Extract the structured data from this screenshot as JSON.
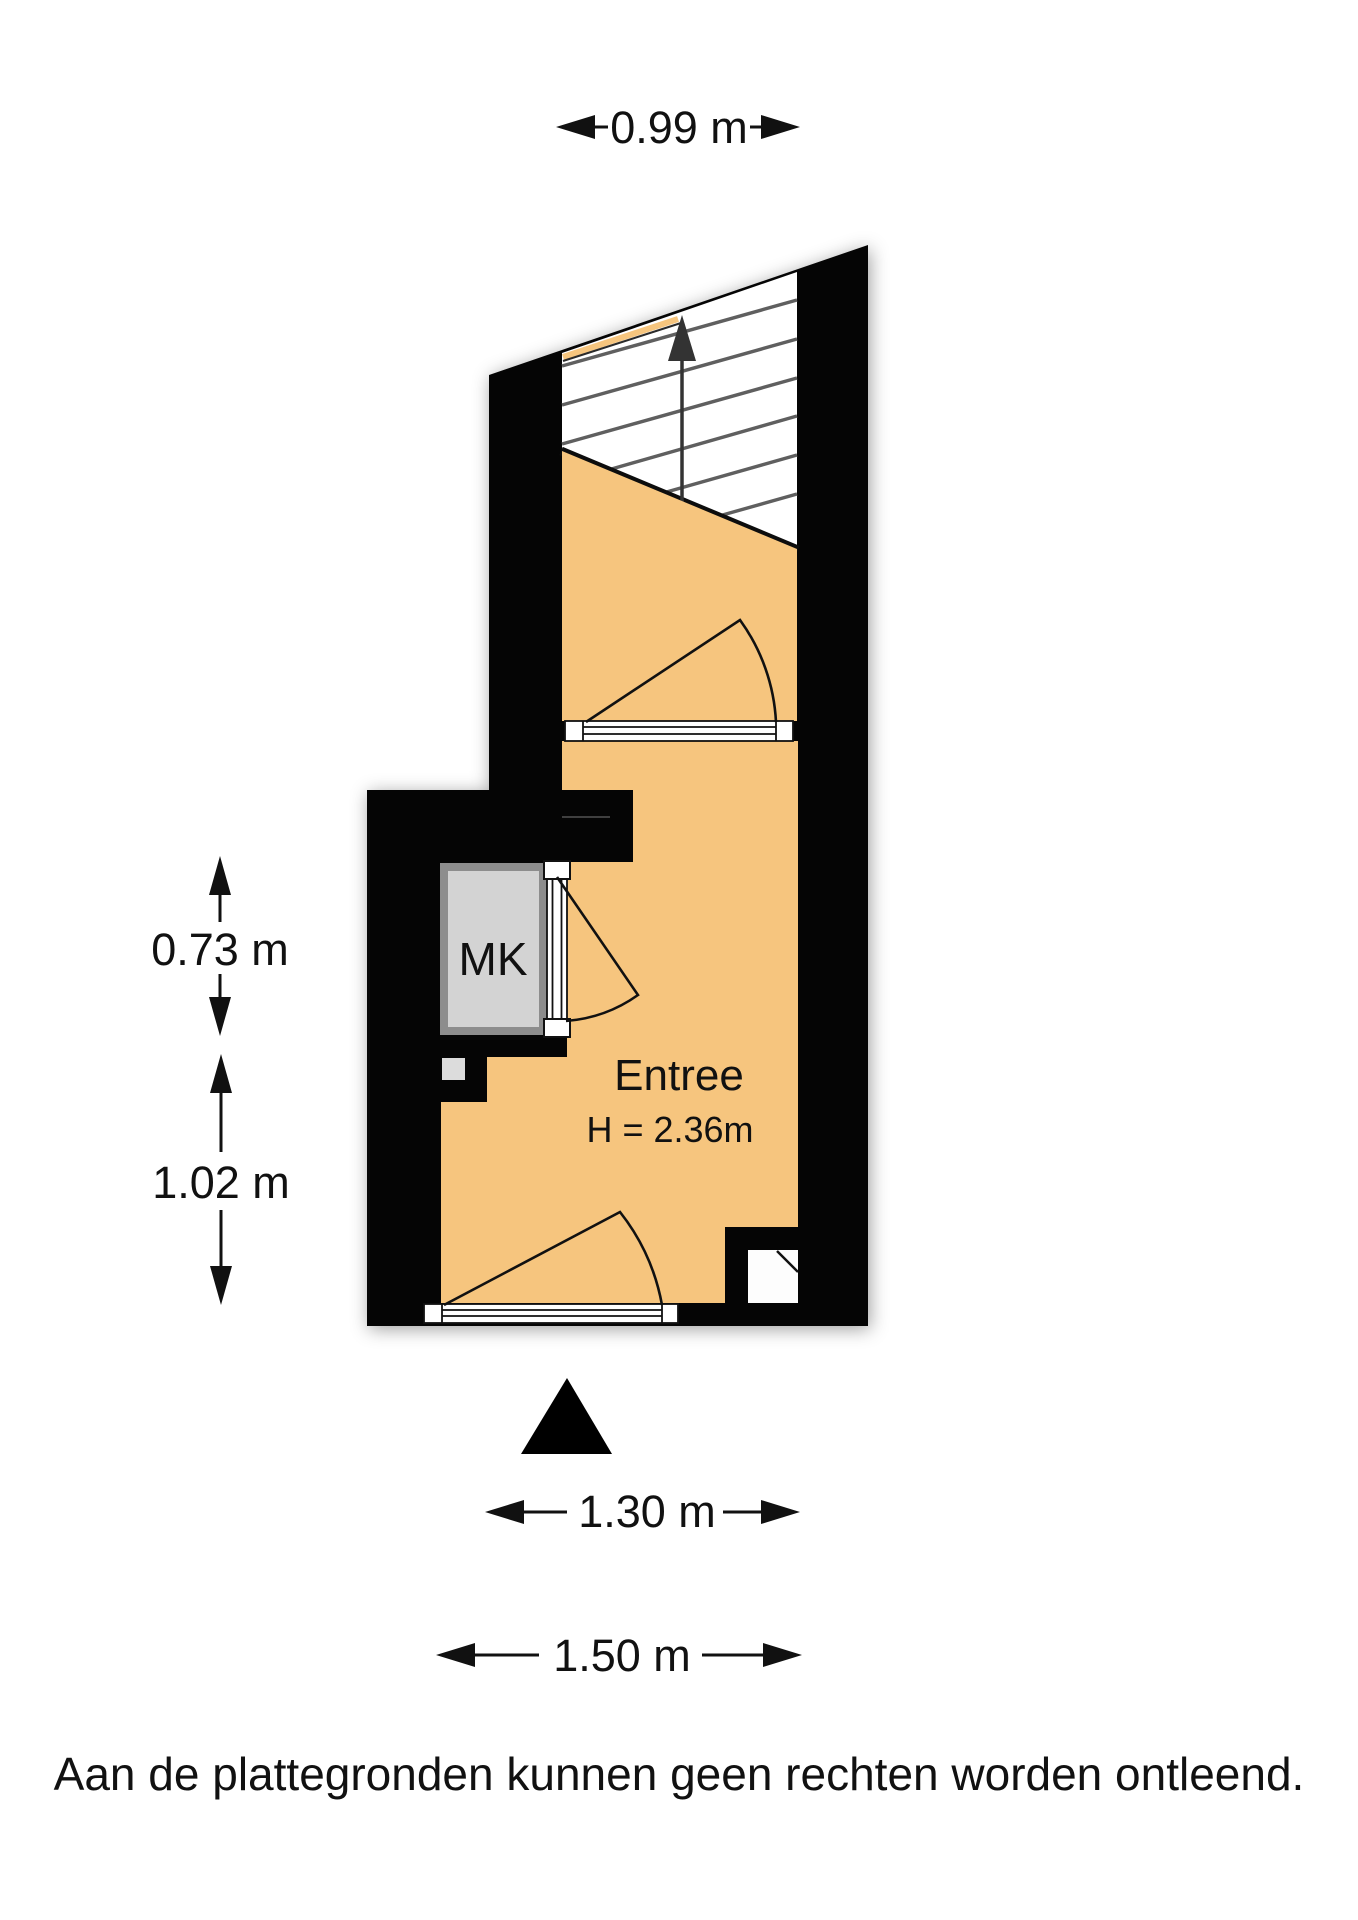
{
  "dimensions": {
    "top_width": "0.99 m",
    "left_upper": "0.73 m",
    "left_lower": "1.02 m",
    "bottom_inner": "1.30 m",
    "bottom_outer": "1.50 m"
  },
  "rooms": {
    "entree": {
      "name": "Entree",
      "ceiling_height": "H = 2.36m"
    },
    "meter_cupboard": {
      "abbr": "MK"
    }
  },
  "stairs": {
    "direction": "up"
  },
  "footer": {
    "disclaimer": "Aan de plattegronden kunnen geen rechten worden ontleend."
  },
  "colors": {
    "wall": "#050505",
    "floor": "#f6c57e",
    "stairs": "#ffffff",
    "closet_frame": "#8d8d8d",
    "closet_fill": "#d3d3d3",
    "niche": "#fdfdfd",
    "marker": "#000000",
    "arrow": "#333333"
  }
}
